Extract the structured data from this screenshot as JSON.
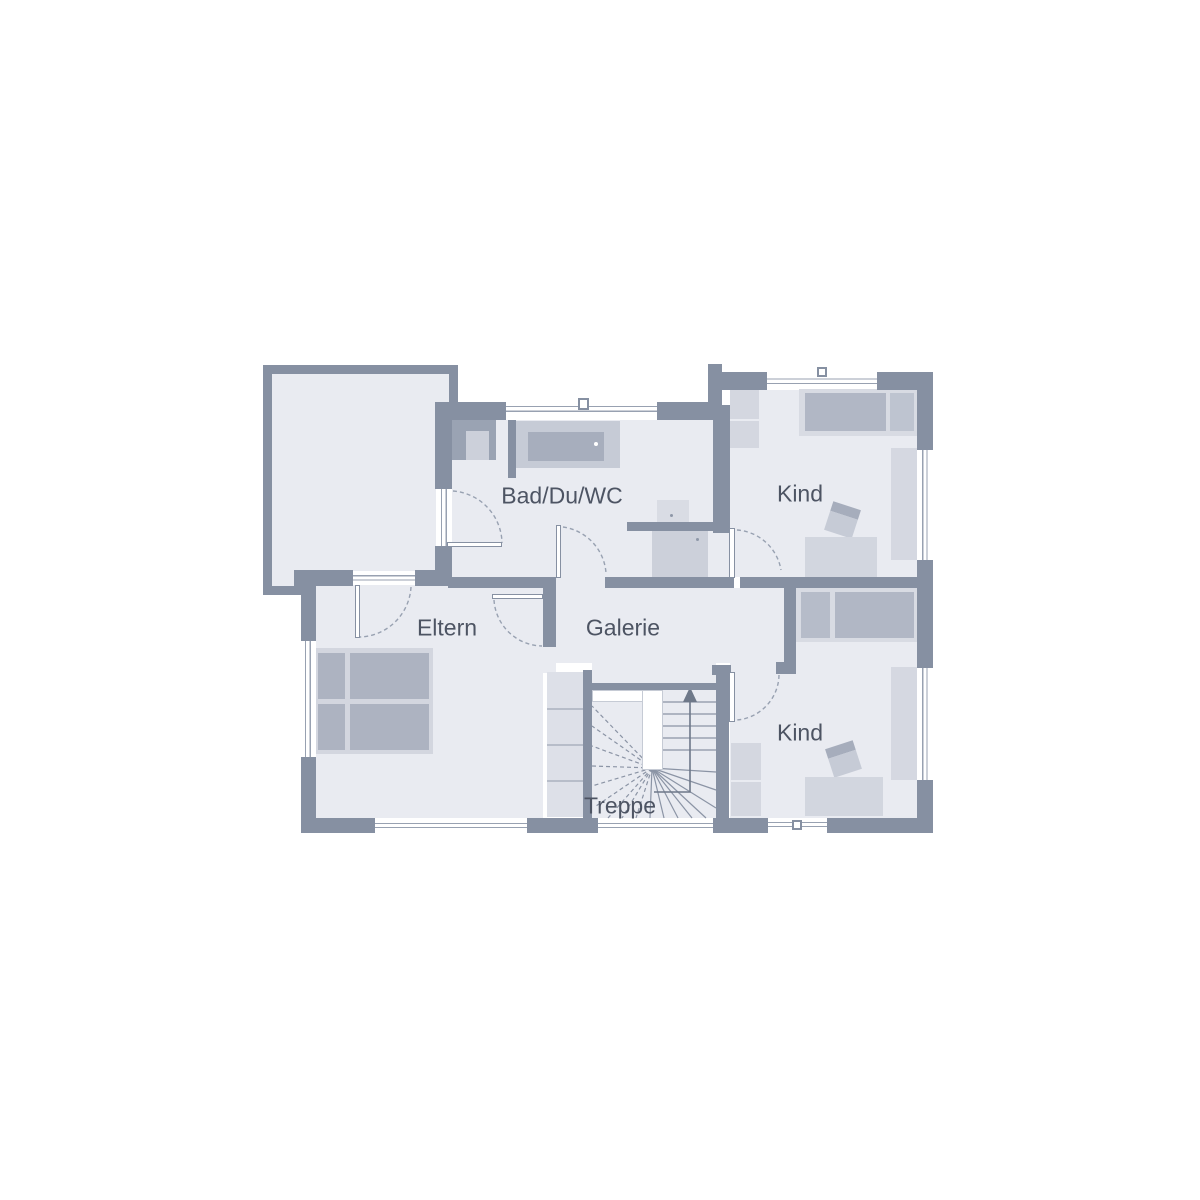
{
  "rooms": [
    {
      "id": "bad",
      "label": "Bad/Du/WC"
    },
    {
      "id": "kind_top",
      "label": "Kind"
    },
    {
      "id": "eltern",
      "label": "Eltern"
    },
    {
      "id": "galerie",
      "label": "Galerie"
    },
    {
      "id": "kind_bottom",
      "label": "Kind"
    },
    {
      "id": "treppe",
      "label": "Treppe"
    }
  ],
  "colors": {
    "wall": "#8690a2",
    "floor": "#e9ebf1",
    "background": "#ffffff",
    "window_line": "#98a1b1",
    "stair_line": "#8b94a5",
    "arrow": "#6e7889",
    "text": "#4d5463",
    "furniture_light": "#d4d7e0",
    "furniture_mid": "#c9cdd8",
    "furniture_dark": "#adb3c1",
    "fixture_light": "#ccd0da"
  }
}
